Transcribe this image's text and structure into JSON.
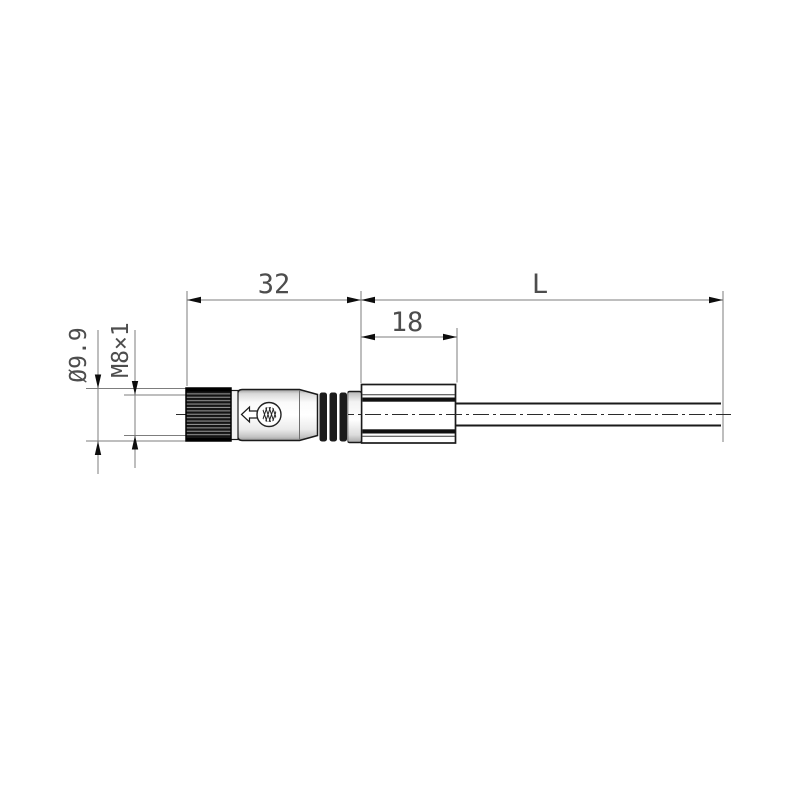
{
  "diagram": {
    "dimension_labels": {
      "connector_length": "32",
      "boot_length": "18",
      "cable_length": "L",
      "nut_diameter": "Ø9.9",
      "thread_size": "M8×1"
    },
    "colors": {
      "background": "#ffffff",
      "part_outline": "#1a1a1a",
      "dimension_lines": "#7d7d7d",
      "dimension_text": "#4d4d4d",
      "knurl_dark": "#141414",
      "body_highlight": "#ffffff",
      "ring_dark": "#1c1c1c"
    },
    "icons": {
      "logo": "weidmueller-logo-icon",
      "direction": "mating-direction-arrow-icon"
    }
  }
}
